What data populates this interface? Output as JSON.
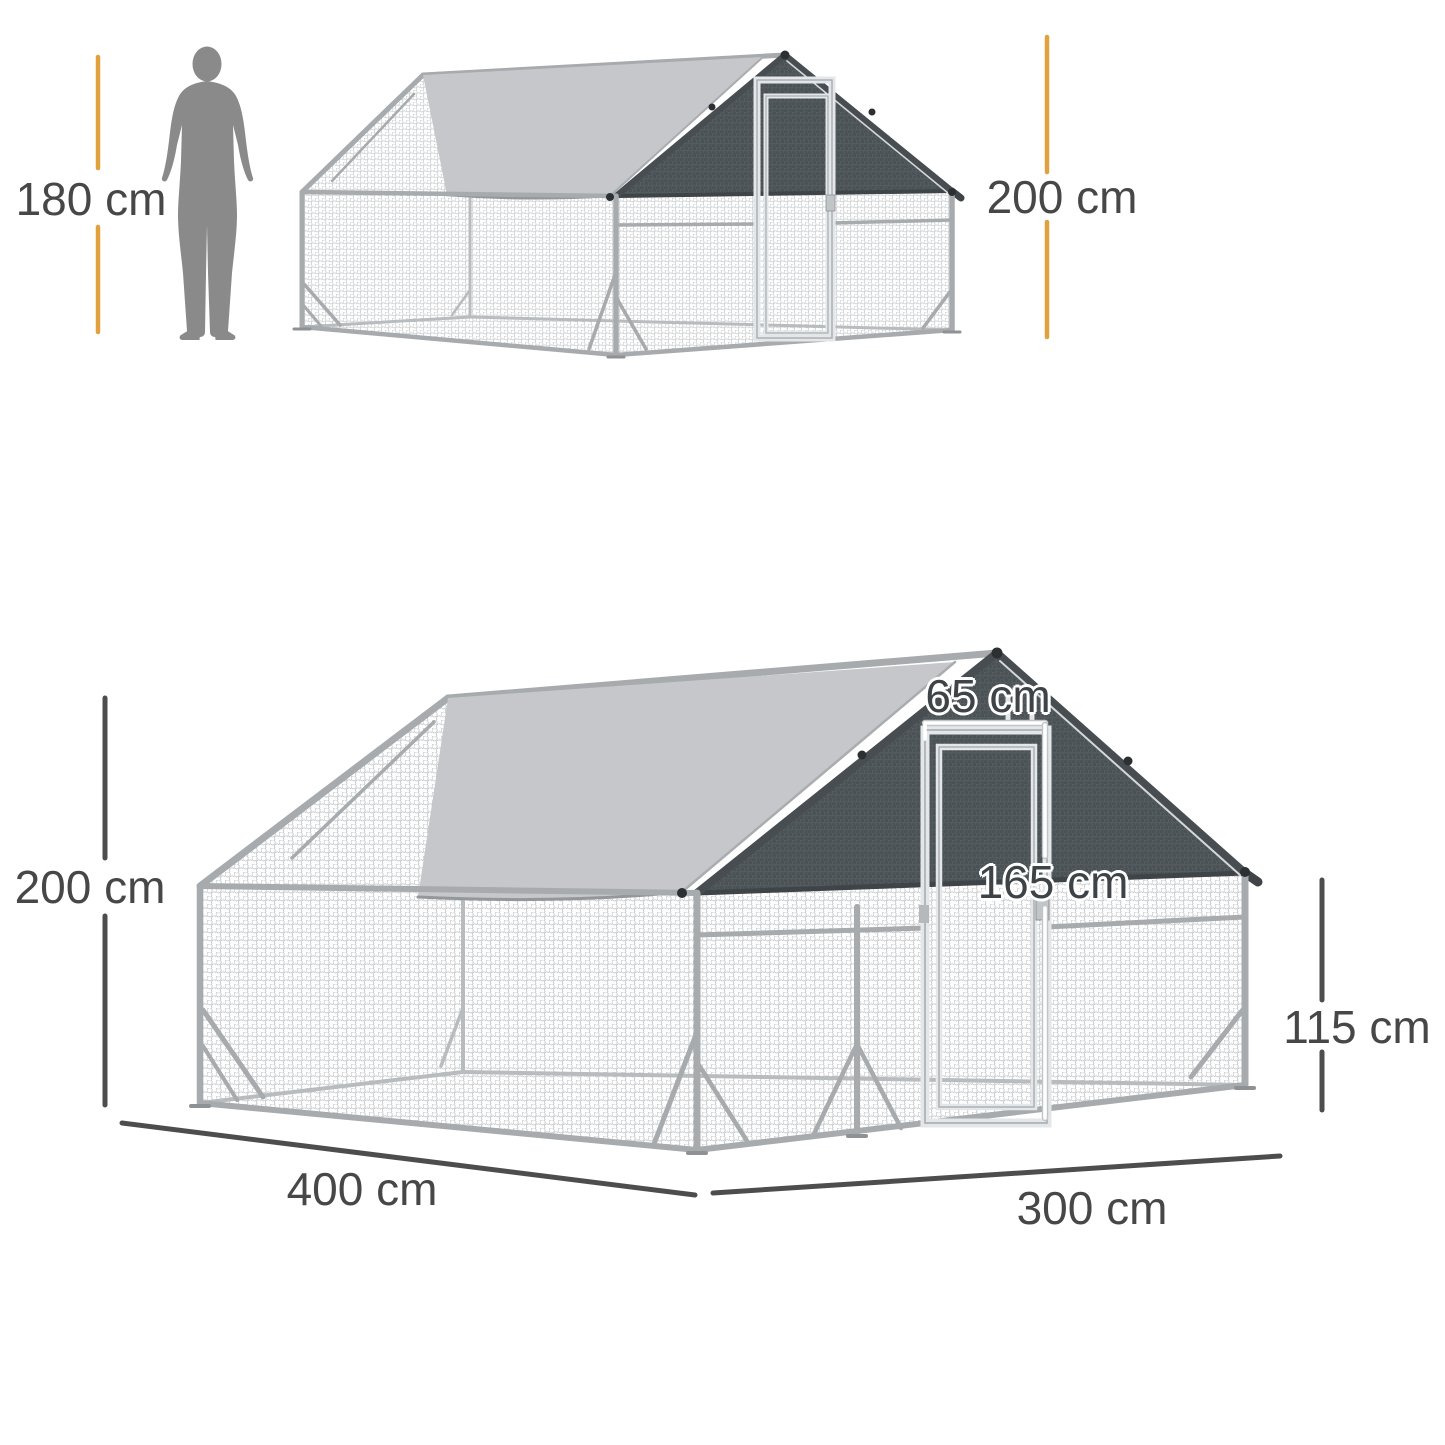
{
  "colors": {
    "accent_yellow": "#E0A13E",
    "dimension_gray": "#4D4D4D",
    "label_text": "#474747",
    "tarp_gray": "#C5C7CA",
    "roof_cover_dark": "#4B5255",
    "frame_silver": "#A7ABAE",
    "mesh_line": "#C9CCCF",
    "silhouette_gray": "#8A8A8A",
    "background": "#FFFFFF"
  },
  "icons": {
    "human_silhouette": "standing-man-silhouette",
    "mesh": "hexagonal-wire-mesh",
    "roof_tarp": "light-gray-roof-cover",
    "roof_cover": "dark-mesh-gable-cover"
  },
  "top_figure": {
    "human_height": "180 cm",
    "total_height": "200 cm"
  },
  "bottom_figure": {
    "total_height": "200 cm",
    "door_width": "65 cm",
    "door_height": "165 cm",
    "side_wall_height": "115 cm",
    "length": "400 cm",
    "width": "300 cm"
  }
}
